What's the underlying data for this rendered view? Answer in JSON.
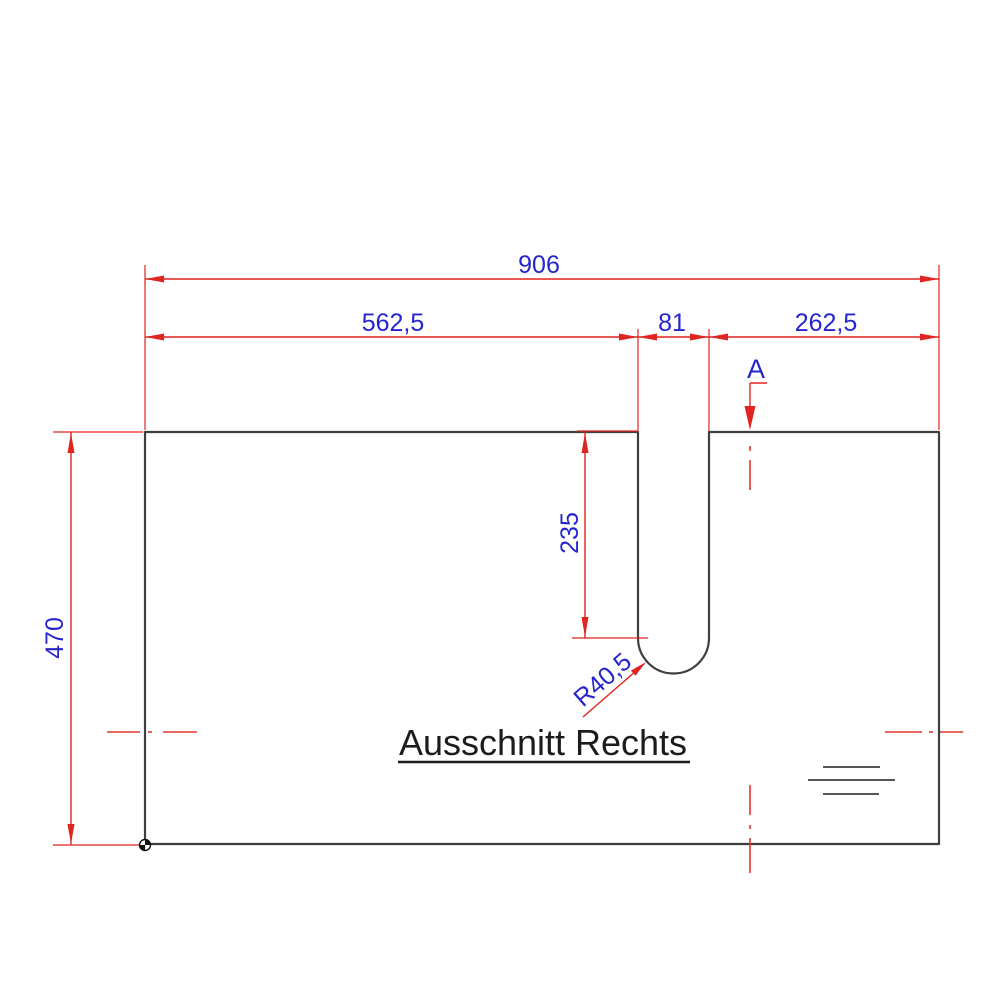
{
  "title": "Ausschnitt Rechts",
  "colors": {
    "dimension_line": "#e02420",
    "dimension_text": "#2525cf",
    "outline": "#3f3f3f",
    "background": "#ffffff"
  },
  "dimensions": {
    "overall_width": "906",
    "left_segment": "562,5",
    "slot_width": "81",
    "right_segment": "262,5",
    "overall_height": "470",
    "slot_depth": "235",
    "slot_radius": "R40,5"
  },
  "section": {
    "label": "A"
  }
}
